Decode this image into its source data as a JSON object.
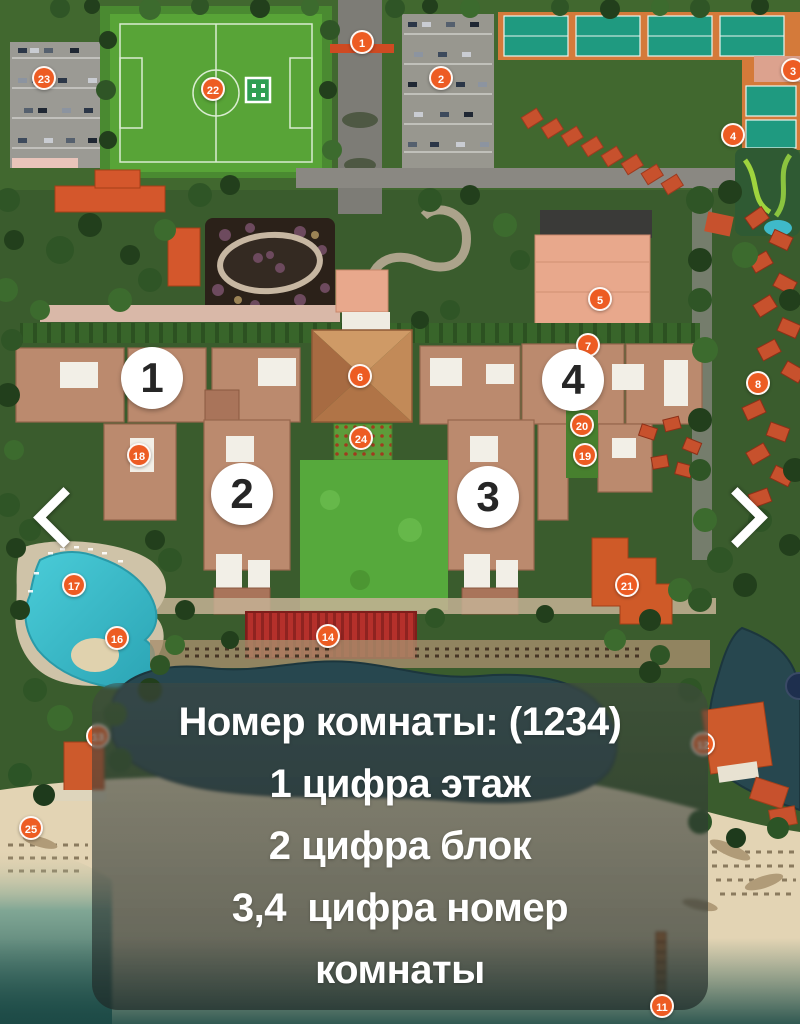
{
  "legend_panel": {
    "lines": [
      "Номер комнаты: (1234)",
      "1 цифра этаж",
      "2 цифра блок",
      "3,4  цифра номер",
      "комнаты"
    ]
  },
  "navigation": {
    "prev_label": "previous image",
    "next_label": "next image"
  },
  "map": {
    "block_labels": [
      {
        "label": "1",
        "x": 152,
        "y": 378
      },
      {
        "label": "2",
        "x": 242,
        "y": 494
      },
      {
        "label": "3",
        "x": 488,
        "y": 497
      },
      {
        "label": "4",
        "x": 573,
        "y": 380
      }
    ],
    "markers": [
      {
        "label": "1",
        "x": 362,
        "y": 42
      },
      {
        "label": "2",
        "x": 441,
        "y": 78
      },
      {
        "label": "3",
        "x": 793,
        "y": 70
      },
      {
        "label": "4",
        "x": 733,
        "y": 135
      },
      {
        "label": "22",
        "x": 213,
        "y": 89
      },
      {
        "label": "23",
        "x": 44,
        "y": 78
      },
      {
        "label": "5",
        "x": 600,
        "y": 299
      },
      {
        "label": "6",
        "x": 360,
        "y": 376
      },
      {
        "label": "7",
        "x": 588,
        "y": 345
      },
      {
        "label": "8",
        "x": 758,
        "y": 383
      },
      {
        "label": "24",
        "x": 361,
        "y": 438
      },
      {
        "label": "18",
        "x": 139,
        "y": 455
      },
      {
        "label": "20",
        "x": 582,
        "y": 425
      },
      {
        "label": "19",
        "x": 585,
        "y": 455
      },
      {
        "label": "17",
        "x": 74,
        "y": 585
      },
      {
        "label": "16",
        "x": 117,
        "y": 638
      },
      {
        "label": "14",
        "x": 328,
        "y": 636
      },
      {
        "label": "21",
        "x": 627,
        "y": 585
      },
      {
        "label": "25",
        "x": 31,
        "y": 828
      },
      {
        "label": "13",
        "x": 98,
        "y": 736
      },
      {
        "label": "12",
        "x": 703,
        "y": 744
      },
      {
        "label": "11",
        "x": 662,
        "y": 1006,
        "above": true
      }
    ],
    "colors": {
      "marker": "#ed5c23",
      "marker_ring": "#ffffff",
      "block_label_bg": "#ffffff",
      "block_label_text": "#262626",
      "panel_text": "#ffffff"
    }
  }
}
